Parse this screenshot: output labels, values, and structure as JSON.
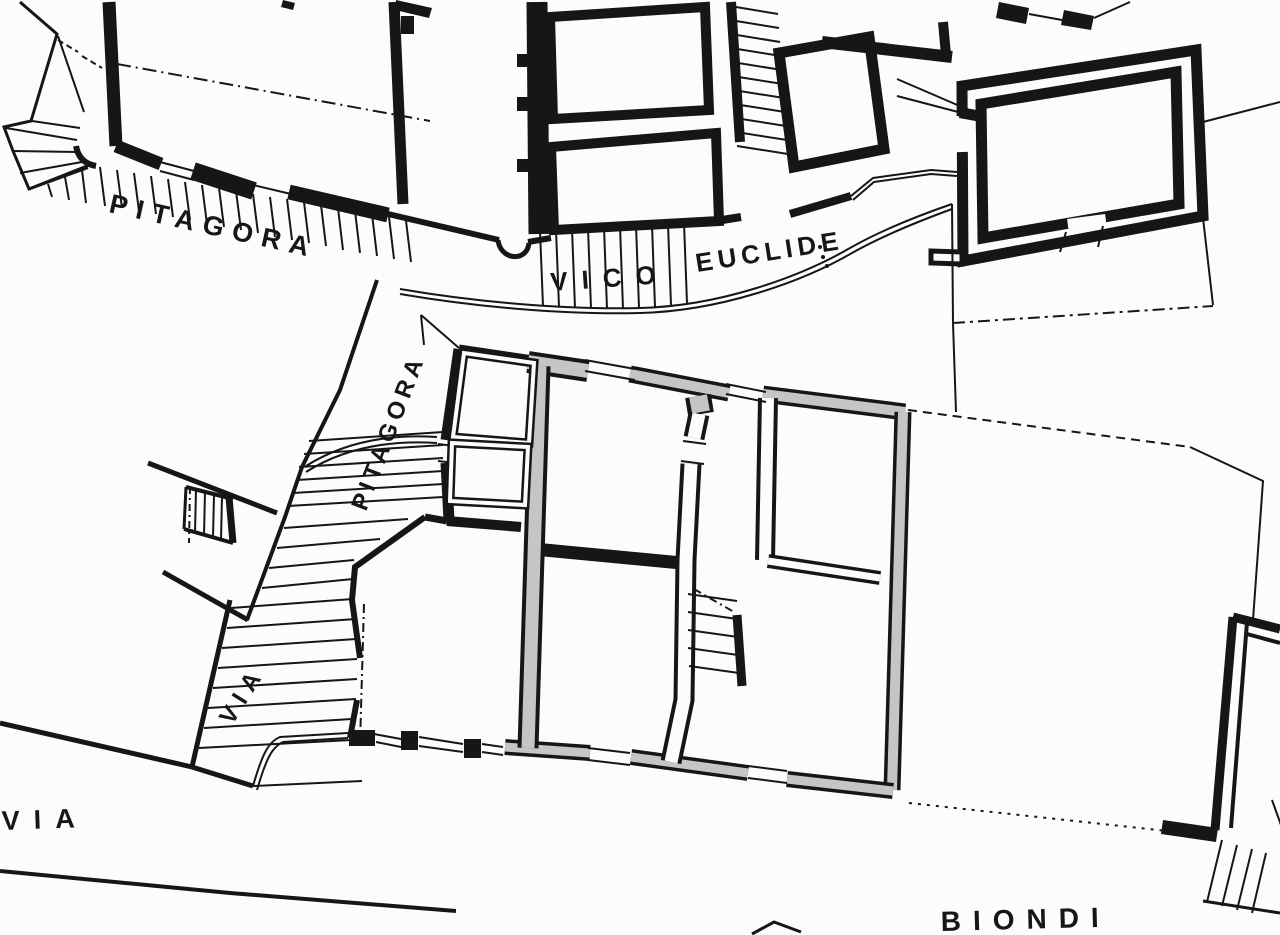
{
  "map": {
    "labels": {
      "pitagora_top": "PITAGORA",
      "vico": "VICO",
      "euclide": "EUCLIDE",
      "pitagora_side": "PITAGORA",
      "via_side": "VIA",
      "via_bottom": "VIA",
      "biondi": "BIONDI"
    },
    "colors": {
      "ink": "#161616",
      "paper": "#fcfcfa",
      "highlight_gray": "#c5c5c5"
    }
  }
}
